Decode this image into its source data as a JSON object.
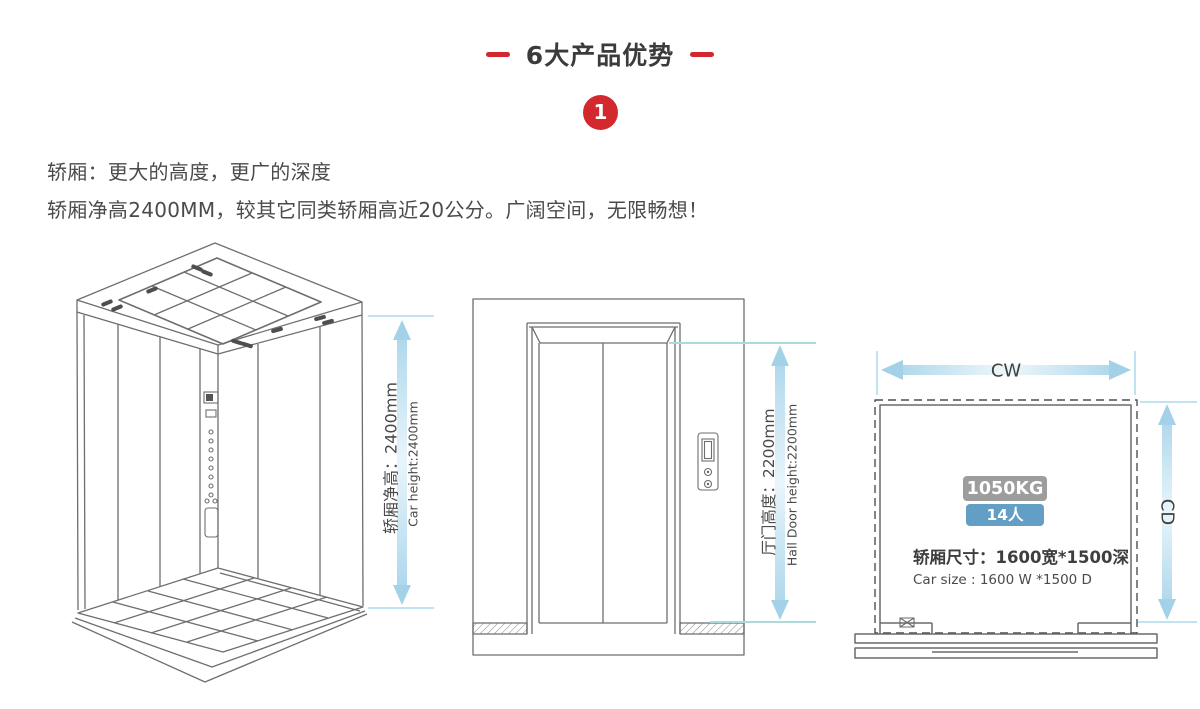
{
  "header": {
    "title": "6大产品优势",
    "step_number": "1"
  },
  "intro": {
    "line1": "轿厢：更大的高度，更广的深度",
    "line2": "轿厢净高2400MM，较其它同类轿厢高近20公分。广阔空间，无限畅想！"
  },
  "diagrams": {
    "car_3d": {
      "dim_cn": "轿厢净高：2400mm",
      "dim_en": "Car height:2400mm"
    },
    "hall_door": {
      "dim_cn": "厅门高度：2200mm",
      "dim_en": "Hall Door height:2200mm"
    },
    "plan": {
      "width_label": "CW",
      "depth_label": "CD",
      "load_badge": "1050KG",
      "capacity_badge": "14人",
      "size_cn": "轿厢尺寸：1600宽*1500深",
      "size_en": "Car size : 1600 W *1500 D"
    }
  },
  "colors": {
    "accent_red": "#d2282e",
    "dimension_arrow_blue": "#a3d2e8",
    "extension_line_blue": "#bfe3f2",
    "line_gray": "#6e6e6e",
    "badge_gray": "#9d9d9d",
    "badge_blue": "#639fc4",
    "title_text": "#3b3b3b",
    "body_text": "#4b4b4b"
  }
}
